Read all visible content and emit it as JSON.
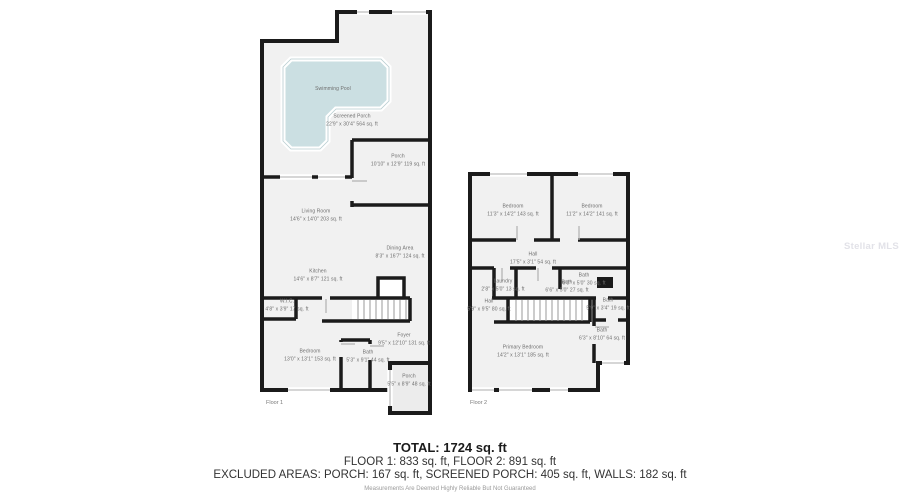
{
  "watermark": "Stellar MLS",
  "floor1": {
    "label": "Floor 1",
    "swimming_pool": {
      "name": "Swimming Pool"
    },
    "screened_porch": {
      "name": "Screened Porch",
      "dims": "22'9\" x 30'4\" 564 sq. ft"
    },
    "porch_top": {
      "name": "Porch",
      "dims": "10'10\" x 12'9\" 119 sq. ft"
    },
    "living_room": {
      "name": "Living Room",
      "dims": "14'6\" x 14'0\" 203 sq. ft"
    },
    "dining_area": {
      "name": "Dining Area",
      "dims": "8'3\" x 16'7\" 124 sq. ft"
    },
    "kitchen": {
      "name": "Kitchen",
      "dims": "14'6\" x 8'7\" 121 sq. ft"
    },
    "wic": {
      "name": "W.I.C.",
      "dims": "4'8\" x 3'9\" 17 sq. ft"
    },
    "bedroom": {
      "name": "Bedroom",
      "dims": "13'0\" x 13'1\" 153 sq. ft"
    },
    "bath": {
      "name": "Bath",
      "dims": "5'3\" x 9'1\" 44 sq. ft"
    },
    "foyer": {
      "name": "Foyer",
      "dims": "9'5\" x 12'10\" 131 sq. ft"
    },
    "porch_bottom": {
      "name": "Porch",
      "dims": "5'5\" x 8'9\" 48 sq. ft"
    }
  },
  "floor2": {
    "label": "Floor 2",
    "bedroom_left": {
      "name": "Bedroom",
      "dims": "11'3\" x 14'2\" 143 sq. ft"
    },
    "bedroom_right": {
      "name": "Bedroom",
      "dims": "11'2\" x 14'2\" 141 sq. ft"
    },
    "hall_upper": {
      "name": "Hall",
      "dims": "17'5\" x 3'1\" 54 sq. ft"
    },
    "laundry": {
      "name": "Laundry",
      "dims": "2'8\" x 5'0\" 13 sq. ft"
    },
    "bath_a": {
      "name": "Bath",
      "dims": "6'0\" x 5'0\" 30 sq. ft"
    },
    "bath_b": {
      "name": "Bath",
      "dims": "6'6\" x 5'0\" 27 sq. ft"
    },
    "hall_lower": {
      "name": "Hall",
      "dims": "5'9\" x 9'5\" 80 sq. ft"
    },
    "bath_small": {
      "name": "Bath",
      "dims": "5'9\" x 3'4\" 19 sq. ft"
    },
    "bath_large": {
      "name": "Bath",
      "dims": "6'3\" x 8'10\" 64 sq. ft"
    },
    "primary_bedroom": {
      "name": "Primary Bedroom",
      "dims": "14'2\" x 13'1\" 185 sq. ft"
    }
  },
  "summary": {
    "total": "TOTAL: 1724 sq. ft",
    "floors": "FLOOR 1: 833 sq. ft, FLOOR 2: 891 sq. ft",
    "excluded": "EXCLUDED AREAS: PORCH: 167 sq. ft, SCREENED PORCH: 405 sq. ft, WALLS: 182 sq. ft",
    "disclaimer": "Measurements Are Deemed Highly Reliable But Not Guaranteed"
  }
}
